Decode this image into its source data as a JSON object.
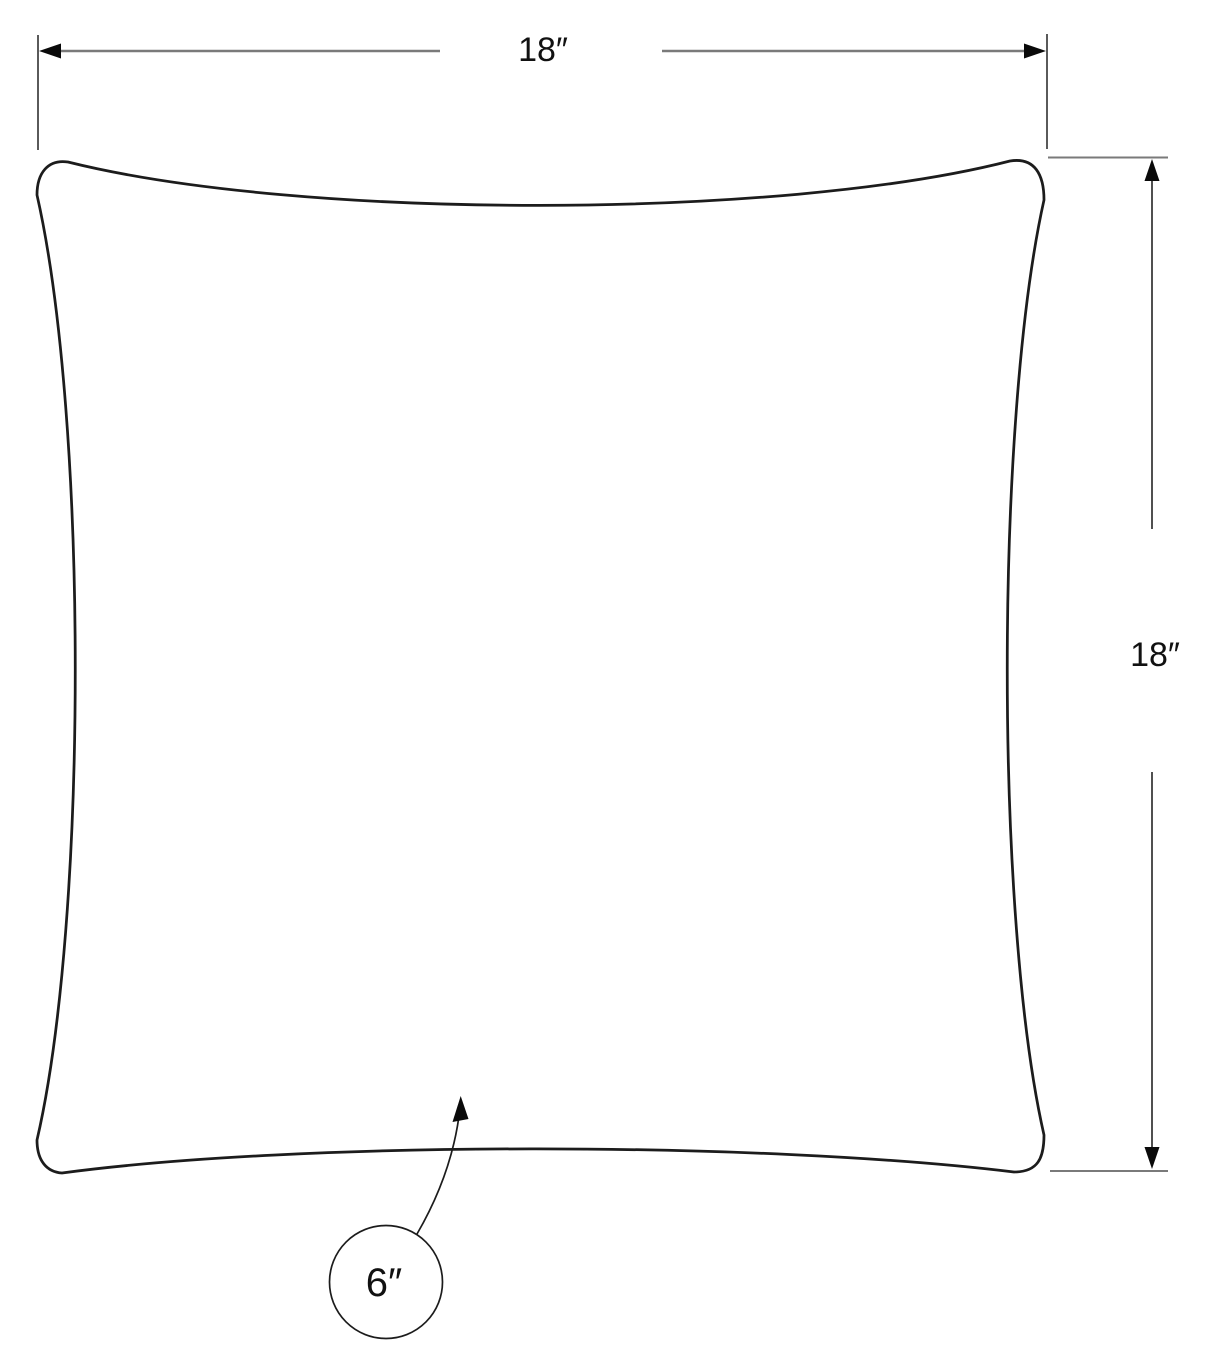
{
  "diagram": {
    "subject": "pillow",
    "dimensions": {
      "width": {
        "label": "18″"
      },
      "height": {
        "label": "18″"
      },
      "depth": {
        "label": "6″"
      }
    },
    "colors": {
      "background": "#ffffff",
      "outline": "#1c1c1c",
      "dimension_line_gray": "#7a7a7a",
      "extension_line_gray": "#5a5a5a",
      "vertical_dimension_line": "#3c3c3c",
      "arrowhead": "#0a0a0a",
      "text": "#111111"
    }
  }
}
